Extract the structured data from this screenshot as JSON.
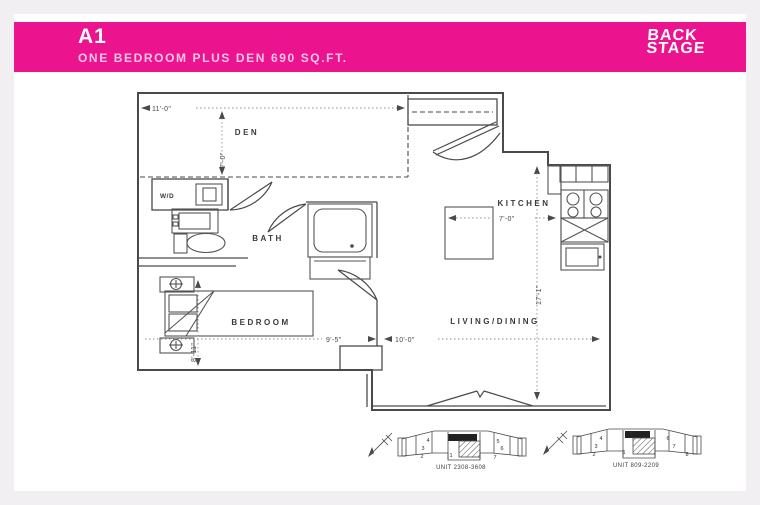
{
  "header": {
    "plan_code": "A1",
    "plan_subtitle": "ONE BEDROOM PLUS DEN 690 SQ.FT.",
    "brand": {
      "line1": "BACK",
      "line2": "STAGE"
    },
    "banner_color": "#EC148E"
  },
  "floorplan": {
    "labels": {
      "den": "DEN",
      "wd": "W/D",
      "bath": "BATH",
      "bedroom": "BEDROOM",
      "kitchen": "KITCHEN",
      "living": "LIVING/DINING"
    },
    "dims": {
      "den_width": "11'-0\"",
      "den_depth": "7'-0\"",
      "kitchen_width": "7'-0\"",
      "bedroom_width": "9'-5\"",
      "bedroom_depth": "8'-11\"",
      "living_width": "10'-0\"",
      "living_length": "17'-1\""
    }
  },
  "keyplans": [
    {
      "label": "UNIT 2308-3608",
      "units": [
        "4",
        "5",
        "3",
        "2",
        "1",
        "6",
        "7"
      ]
    },
    {
      "label": "UNIT 809-2209",
      "units": [
        "5",
        "4",
        "6",
        "3",
        "7",
        "2",
        "1",
        "8"
      ]
    }
  ]
}
